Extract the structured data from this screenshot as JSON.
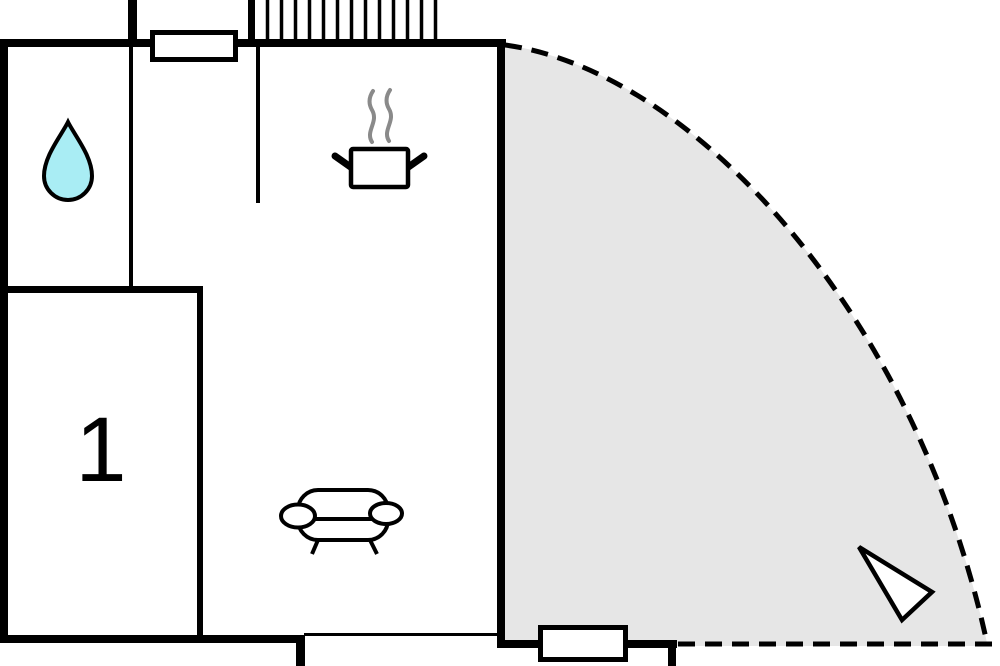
{
  "floorplan": {
    "room_label": "1",
    "colors": {
      "background": "#ffffff",
      "wall": "#000000",
      "terrace_fill": "#e6e6e6",
      "window_fill": "#ffffff",
      "water_drop_fill": "#a9edf4",
      "steam_stroke": "#8a8a8a",
      "icon_fill": "#ffffff",
      "label_color": "#000000"
    },
    "icons": {
      "water_drop": "water-drop-icon",
      "cooking_pot": "cooking-pot-icon",
      "sofa": "sofa-icon",
      "north_arrow": "north-arrow-icon",
      "stairs_hatch": "stairs-hatch-icon"
    }
  }
}
